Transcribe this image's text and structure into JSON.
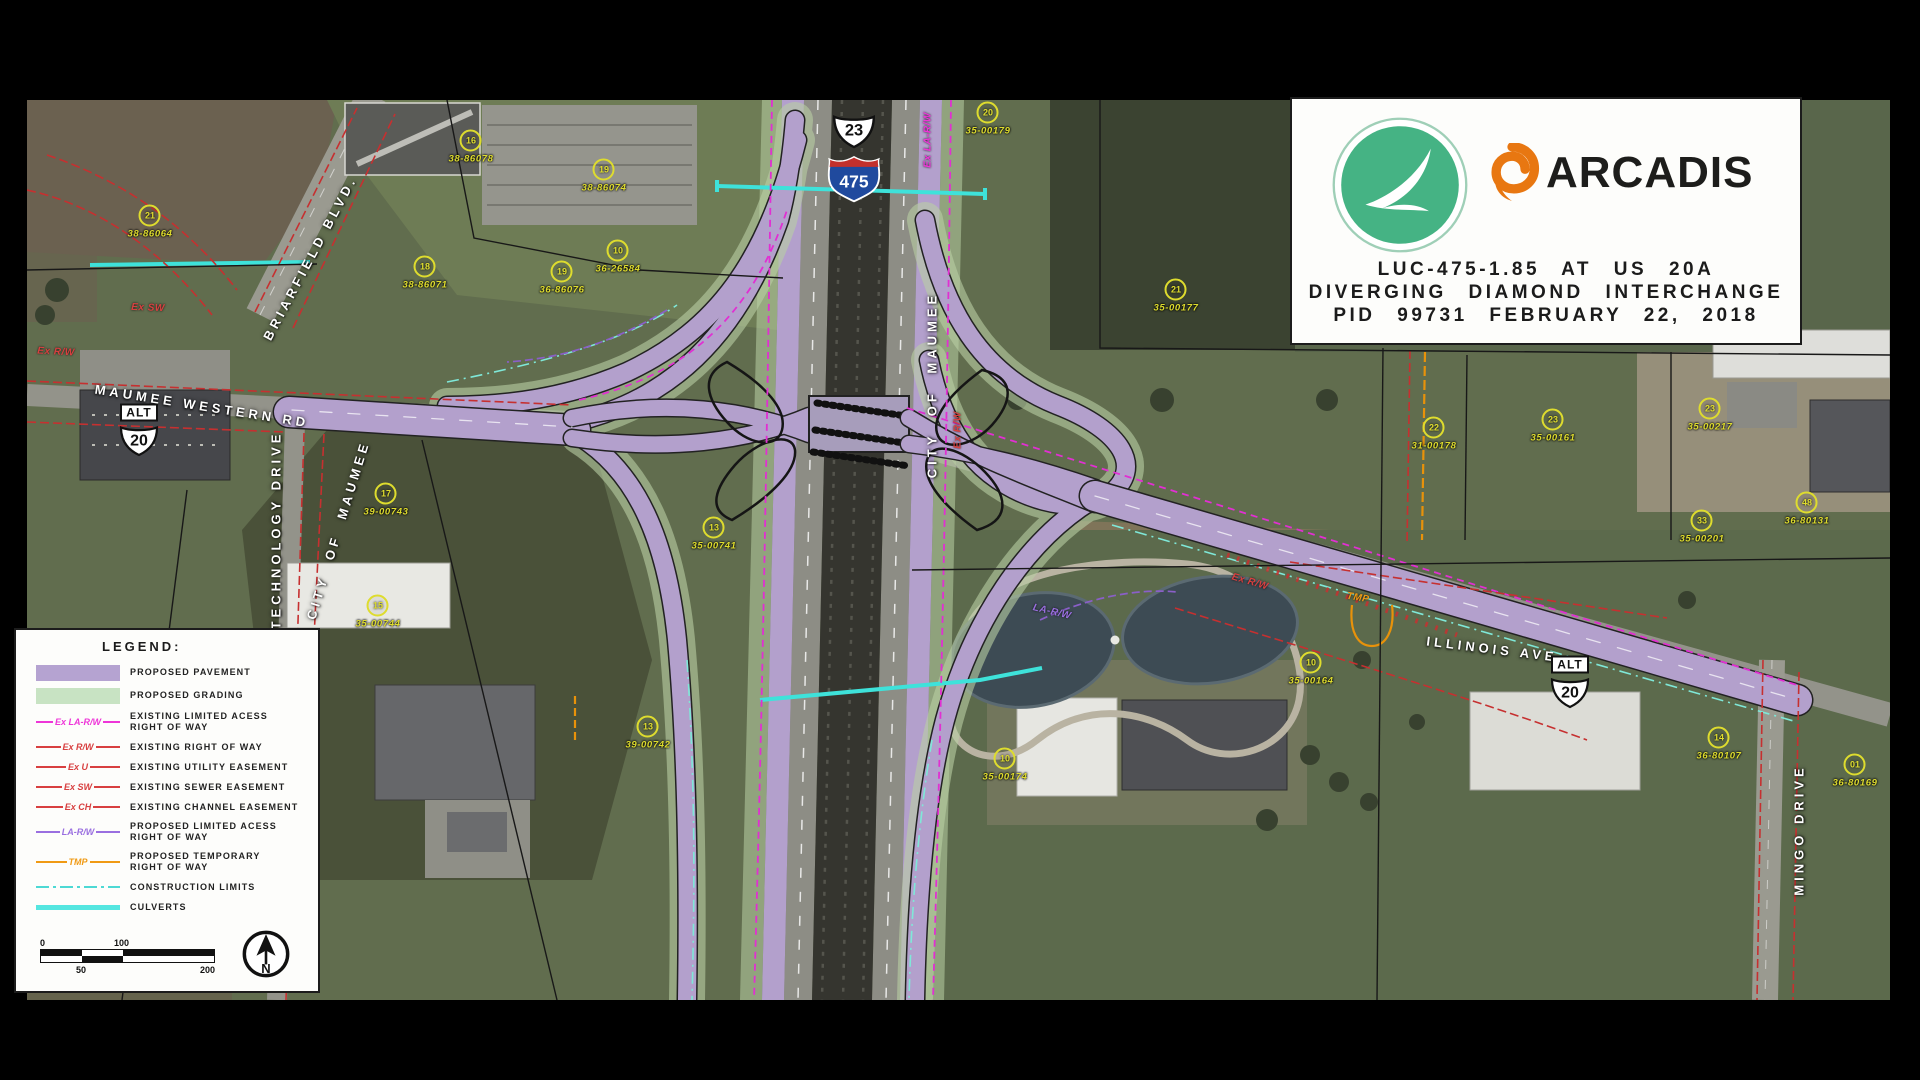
{
  "title_block": {
    "agency_logo": "odot-swoosh-logo",
    "company": "ARCADIS",
    "line1": "LUC-475-1.85 AT US 20A",
    "line2": "DIVERGING DIAMOND INTERCHANGE",
    "line3": "PID 99731 FEBRUARY 22, 2018",
    "colors": {
      "odot_green": "#45b384",
      "arcadis_orange": "#e87711"
    }
  },
  "legend": {
    "heading": "LEGEND:",
    "items": [
      {
        "sample": "",
        "label": "PROPOSED PAVEMENT",
        "color": "#b5a3d1"
      },
      {
        "sample": "",
        "label": "PROPOSED GRADING",
        "color": "#c8e3c3"
      },
      {
        "sample": "Ex LA-R/W",
        "label": "EXISTING LIMITED ACESS",
        "label2": "RIGHT OF WAY",
        "color": "#ee35d8"
      },
      {
        "sample": "Ex R/W",
        "label": "EXISTING RIGHT OF WAY",
        "color": "#c63030"
      },
      {
        "sample": "Ex U",
        "label": "EXISTING UTILITY EASEMENT",
        "color": "#c63030"
      },
      {
        "sample": "Ex SW",
        "label": "EXISTING SEWER EASEMENT",
        "color": "#c63030"
      },
      {
        "sample": "Ex CH",
        "label": "EXISTING CHANNEL EASEMENT",
        "color": "#c63030"
      },
      {
        "sample": "LA-R/W",
        "label": "PROPOSED LIMITED ACESS",
        "label2": "RIGHT OF WAY",
        "color": "#8a5fc8"
      },
      {
        "sample": "TMP",
        "label": "PROPOSED TEMPORARY",
        "label2": "RIGHT OF WAY",
        "color": "#e8920a"
      },
      {
        "sample": "",
        "label": "CONSTRUCTION LIMITS",
        "color": "#4dd9d4"
      },
      {
        "sample": "",
        "label": "CULVERTS",
        "color": "#55e6e0"
      }
    ],
    "scale": {
      "zero": "0",
      "hundred": "100",
      "fifty": "50",
      "twohundred": "200"
    },
    "north": "N"
  },
  "map": {
    "shields": {
      "us23": "23",
      "i475": "475",
      "alt": "ALT",
      "us20": "20"
    },
    "roads": [
      {
        "label": "BRIARFIELD BLVD."
      },
      {
        "label": "MAUMEE WESTERN RD"
      },
      {
        "label": "TECHNOLOGY DRIVE"
      },
      {
        "label": "CITY OF MAUMEE"
      },
      {
        "label": "CITY OF MAUMEE"
      },
      {
        "label": "ILLINOIS AVE"
      },
      {
        "label": "MINGO DRIVE"
      }
    ],
    "parcels": [
      {
        "number": "21",
        "id": "38-86064"
      },
      {
        "number": "16",
        "id": "38-86078"
      },
      {
        "number": "19",
        "id": "38-86074"
      },
      {
        "number": "18",
        "id": "38-86071"
      },
      {
        "number": "19",
        "id": "36-86076"
      },
      {
        "number": "10",
        "id": "36-26584"
      },
      {
        "number": "20",
        "id": "35-00179"
      },
      {
        "number": "21",
        "id": "35-00177"
      },
      {
        "number": "17",
        "id": "39-00743"
      },
      {
        "number": "13",
        "id": "35-00741"
      },
      {
        "number": "13",
        "id": "39-00742"
      },
      {
        "number": "10",
        "id": "35-00174"
      },
      {
        "number": "10",
        "id": "35-00164"
      },
      {
        "number": "22",
        "id": "31-00178"
      },
      {
        "number": "23",
        "id": "35-00161"
      },
      {
        "number": "23",
        "id": "35-00217"
      },
      {
        "number": "33",
        "id": "35-00201"
      },
      {
        "number": "48",
        "id": "36-80131"
      },
      {
        "number": "14",
        "id": "36-80107"
      },
      {
        "number": "01",
        "id": "36-80169"
      },
      {
        "number": "15",
        "id": "35-00744"
      }
    ],
    "line_notes": [
      {
        "text": "Ex SW"
      },
      {
        "text": "Ex R/W"
      },
      {
        "text": "Ex LA-R/W"
      },
      {
        "text": "Ex R/W"
      },
      {
        "text": "LA-R/W"
      },
      {
        "text": "TMP"
      },
      {
        "text": "Ex R/W"
      }
    ],
    "overlay_colors": {
      "proposed_pavement": "#b3a0cc",
      "proposed_grading": "#b9cfa4",
      "existing_la_rw": "#e12fd2",
      "existing_rw": "#c63030",
      "proposed_la_rw": "#8a5fc8",
      "temporary_rw": "#e8920a",
      "construction_culvert_cyan": "#3ee2da",
      "parcel_yellow": "#dedc2e"
    }
  }
}
